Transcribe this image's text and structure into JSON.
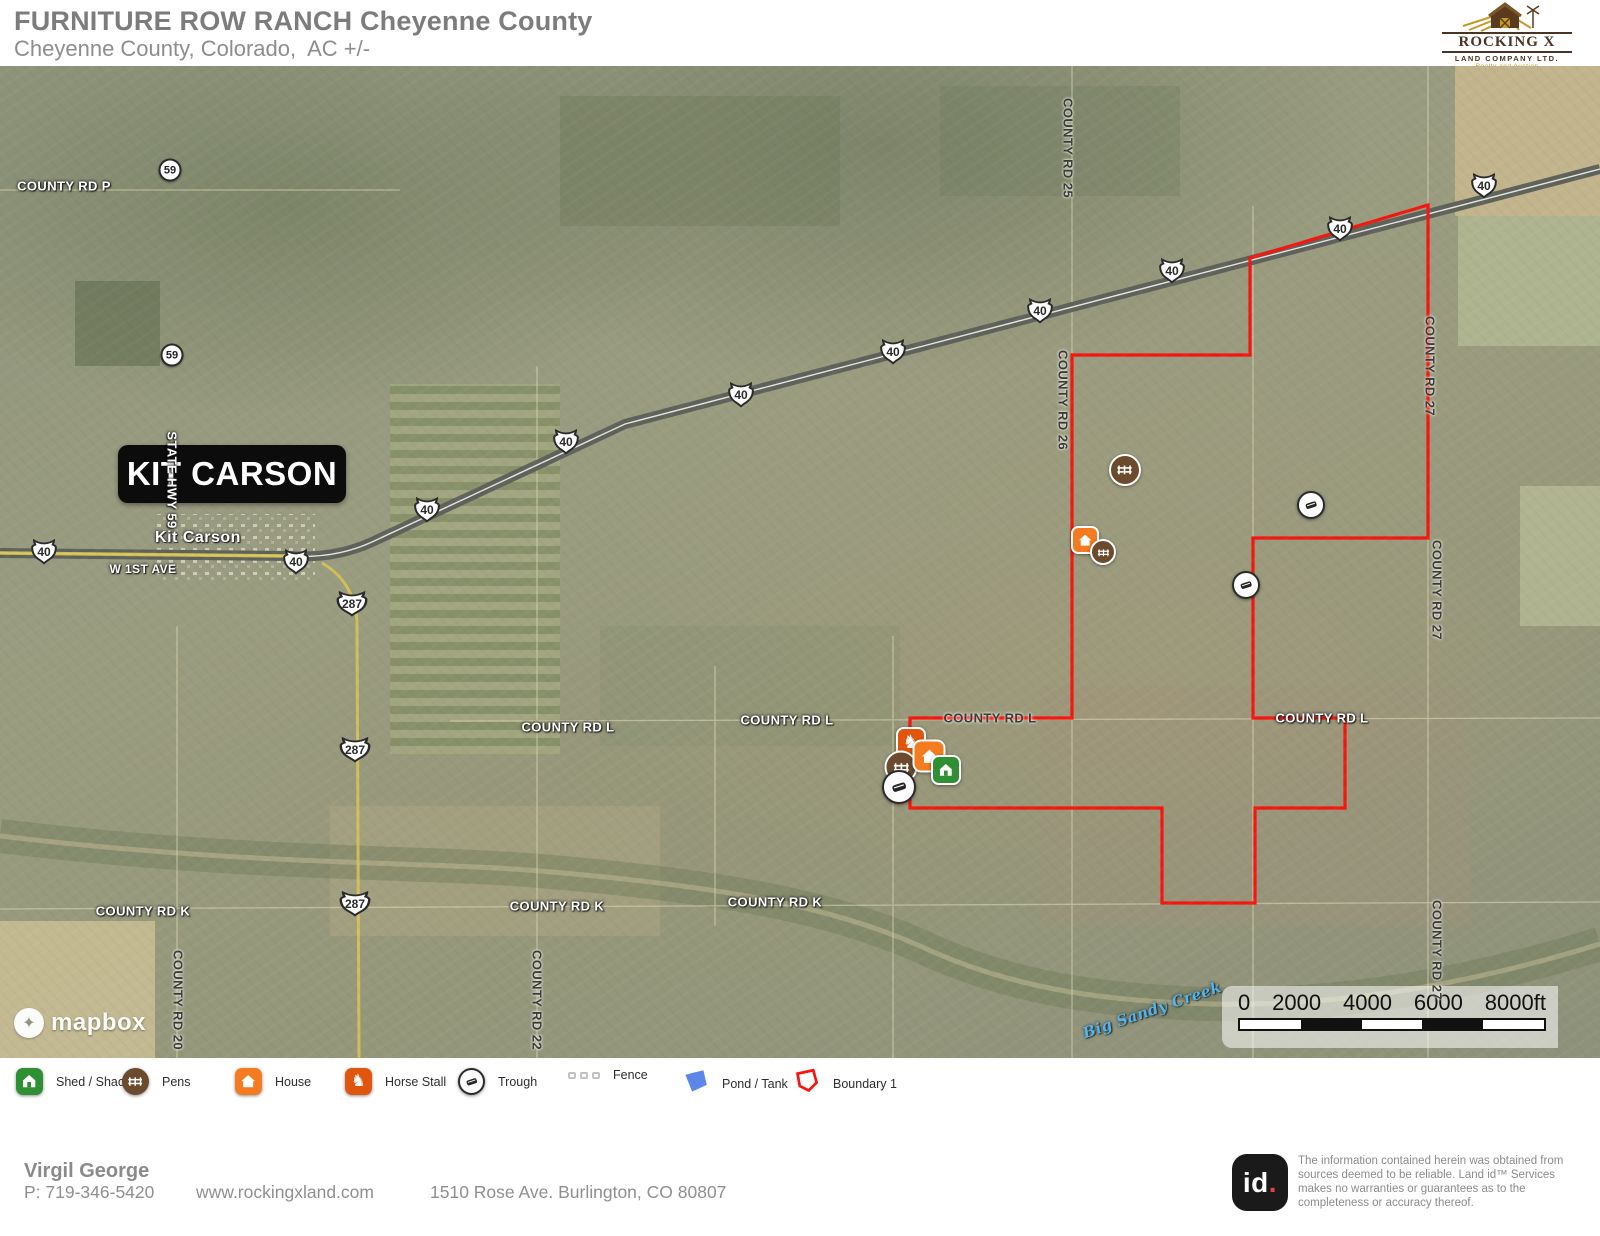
{
  "header": {
    "title": "FURNITURE ROW RANCH Cheyenne County",
    "subtitle": "Cheyenne County, Colorado,  AC +/-"
  },
  "brand": {
    "name": "ROCKING X",
    "sub": "LAND COMPANY LTD.",
    "tagline": "Realty and Auction"
  },
  "colors": {
    "boundary_red": "#f5160f",
    "shed_green": "#2f8f33",
    "pens_brown": "#6b4a2d",
    "house_orange": "#f47b20",
    "stall_orange": "#e0560e",
    "pond_blue": "#5b87e8",
    "fence_gray": "#c2c2c2"
  },
  "map": {
    "town_box": "KIT CARSON",
    "boundary_points": "1428,139 1250,192 1250,289 1072,289 1072,652 910,652 910,742 1162,742 1162,837 1255,837 1255,742 1345,742 1345,652 1253,652 1253,472 1428,472",
    "labels": [
      {
        "text": "COUNTY RD P",
        "x": 64,
        "y": 120,
        "cls": ""
      },
      {
        "text": "Kit Carson",
        "x": 198,
        "y": 472,
        "cls": "town"
      },
      {
        "text": "W 1ST AVE",
        "x": 143,
        "y": 503,
        "cls": "small"
      },
      {
        "text": "STATE HWY 59",
        "x": 172,
        "y": 414,
        "cls": "",
        "rot": 90
      },
      {
        "text": "COUNTY RD L",
        "x": 568,
        "y": 661,
        "cls": ""
      },
      {
        "text": "COUNTY RD L",
        "x": 787,
        "y": 654,
        "cls": ""
      },
      {
        "text": "COUNTY RD L",
        "x": 990,
        "y": 652,
        "cls": "dark"
      },
      {
        "text": "COUNTY RD L",
        "x": 1322,
        "y": 652,
        "cls": ""
      },
      {
        "text": "COUNTY RD K",
        "x": 143,
        "y": 845,
        "cls": ""
      },
      {
        "text": "COUNTY RD K",
        "x": 557,
        "y": 840,
        "cls": ""
      },
      {
        "text": "COUNTY RD K",
        "x": 775,
        "y": 836,
        "cls": ""
      },
      {
        "text": "COUNTY RD 25",
        "x": 1068,
        "y": 82,
        "cls": "dark",
        "rot": 90
      },
      {
        "text": "COUNTY RD 26",
        "x": 1063,
        "y": 334,
        "cls": "dark",
        "rot": 90
      },
      {
        "text": "COUNTY RD 27",
        "x": 1430,
        "y": 300,
        "cls": "dark",
        "rot": 90
      },
      {
        "text": "COUNTY RD 27",
        "x": 1437,
        "y": 524,
        "cls": "dark",
        "rot": 90
      },
      {
        "text": "COUNTY RD 27",
        "x": 1437,
        "y": 884,
        "cls": "dark",
        "rot": 90
      },
      {
        "text": "COUNTY RD 20",
        "x": 178,
        "y": 934,
        "cls": "dark",
        "rot": 90
      },
      {
        "text": "COUNTY RD 22",
        "x": 537,
        "y": 934,
        "cls": "dark",
        "rot": 90
      },
      {
        "text": "Big Sandy Creek",
        "x": 1152,
        "y": 944,
        "cls": "blue",
        "rot": -19
      }
    ],
    "shields": [
      {
        "type": "us",
        "text": "40",
        "x": 44,
        "y": 485
      },
      {
        "type": "us",
        "text": "40",
        "x": 296,
        "y": 495
      },
      {
        "type": "us",
        "text": "40",
        "x": 427,
        "y": 443
      },
      {
        "type": "us",
        "text": "40",
        "x": 566,
        "y": 375
      },
      {
        "type": "us",
        "text": "40",
        "x": 741,
        "y": 328
      },
      {
        "type": "us",
        "text": "40",
        "x": 893,
        "y": 285
      },
      {
        "type": "us",
        "text": "40",
        "x": 1040,
        "y": 244
      },
      {
        "type": "us",
        "text": "40",
        "x": 1172,
        "y": 204
      },
      {
        "type": "us",
        "text": "40",
        "x": 1340,
        "y": 162
      },
      {
        "type": "us",
        "text": "40",
        "x": 1484,
        "y": 119
      },
      {
        "type": "us",
        "text": "287",
        "x": 352,
        "y": 537,
        "wide": true
      },
      {
        "type": "us",
        "text": "287",
        "x": 355,
        "y": 683,
        "wide": true
      },
      {
        "type": "us",
        "text": "287",
        "x": 355,
        "y": 837,
        "wide": true
      },
      {
        "type": "circle",
        "text": "59",
        "x": 170,
        "y": 104
      },
      {
        "type": "circle",
        "text": "59",
        "x": 172,
        "y": 289
      }
    ],
    "icons": [
      {
        "type": "pens",
        "x": 1125,
        "y": 404,
        "s": 32
      },
      {
        "type": "house",
        "x": 1085,
        "y": 474,
        "s": 28
      },
      {
        "type": "pens",
        "x": 1103,
        "y": 486,
        "s": 26
      },
      {
        "type": "trough",
        "x": 1311,
        "y": 439,
        "s": 28
      },
      {
        "type": "trough",
        "x": 1246,
        "y": 519,
        "s": 28
      },
      {
        "type": "stall",
        "x": 911,
        "y": 676,
        "s": 30
      },
      {
        "type": "pens",
        "x": 901,
        "y": 701,
        "s": 33
      },
      {
        "type": "trough",
        "x": 899,
        "y": 721,
        "s": 34
      },
      {
        "type": "house",
        "x": 929,
        "y": 690,
        "s": 33
      },
      {
        "type": "shed",
        "x": 946,
        "y": 704,
        "s": 30
      }
    ],
    "attribution": "mapbox"
  },
  "scalebar": {
    "labels": [
      "0",
      "2000",
      "4000",
      "6000",
      "8000ft"
    ]
  },
  "legend": {
    "items": [
      {
        "type": "shed",
        "label": "Shed / Shack",
        "x": 16
      },
      {
        "type": "pens",
        "label": "Pens",
        "x": 122
      },
      {
        "type": "house",
        "label": "House",
        "x": 235
      },
      {
        "type": "stall",
        "label": "Horse Stall",
        "x": 345
      },
      {
        "type": "trough",
        "label": "Trough",
        "x": 458
      },
      {
        "type": "fence",
        "label": "Fence",
        "x": 568
      },
      {
        "type": "pond",
        "label": "Pond / Tank",
        "x": 682
      },
      {
        "type": "boundary",
        "label": "Boundary 1",
        "x": 793
      }
    ]
  },
  "footer": {
    "name": "Virgil George",
    "phone": "P: 719-346-5420",
    "website": "www.rockingxland.com",
    "address": "1510 Rose Ave. Burlington, CO 80807"
  },
  "landid": {
    "logo_id": "id",
    "logo_dot": ".",
    "disclaimer": "The information contained herein was obtained from sources deemed to be reliable.  Land id™ Services makes no warranties or guarantees as to the completeness or accuracy thereof."
  }
}
